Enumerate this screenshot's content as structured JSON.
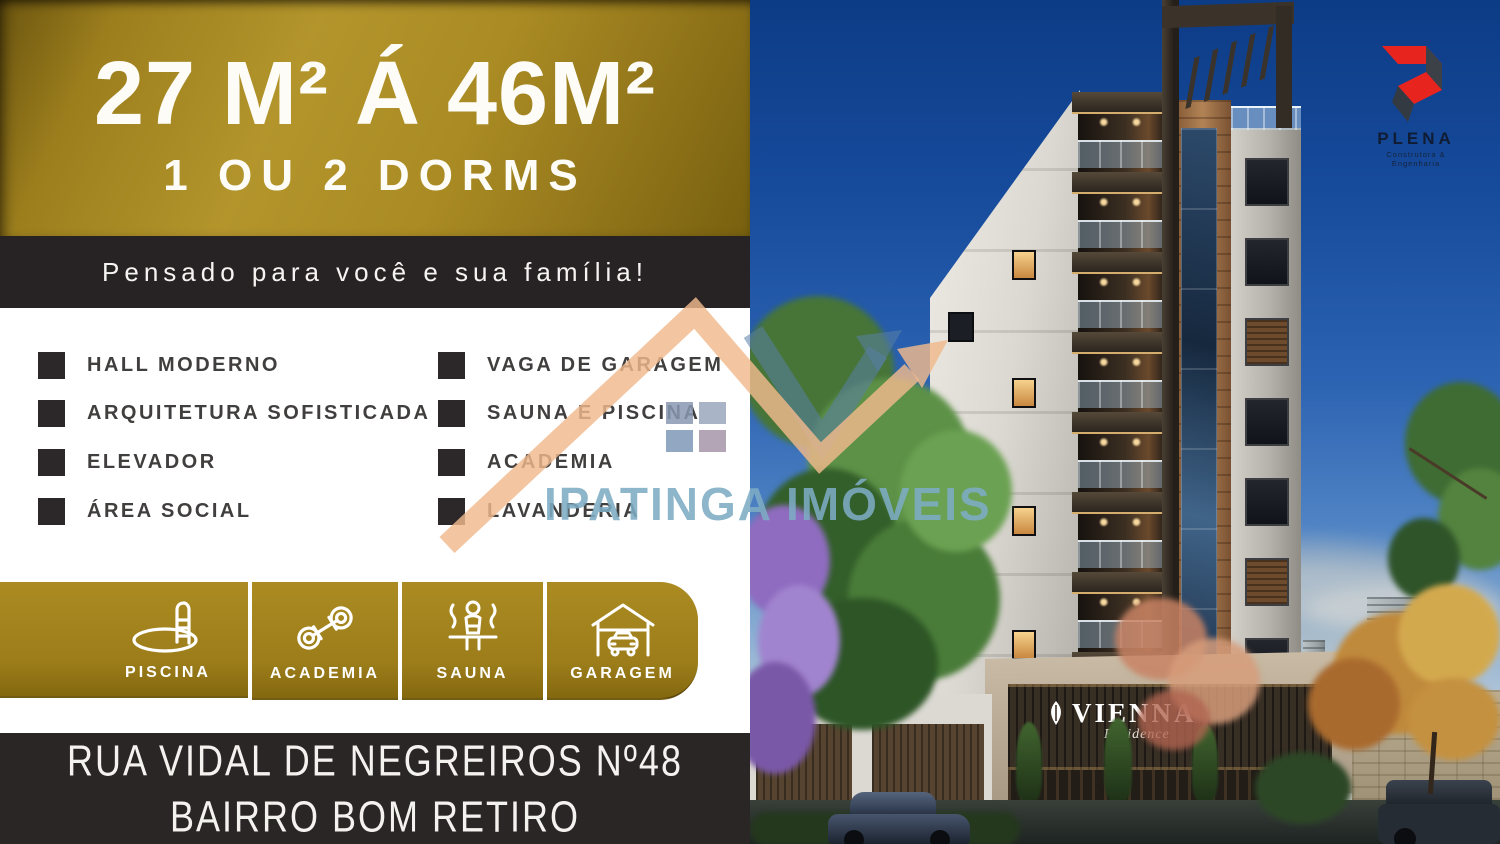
{
  "left": {
    "header": {
      "line1": "27 M² Á 46M²",
      "line2": "1 OU 2 DORMS"
    },
    "tagline": "Pensado para você e sua família!",
    "features": {
      "left": [
        "HALL MODERNO",
        "ARQUITETURA SOFISTICADA",
        "ELEVADOR",
        "ÁREA SOCIAL"
      ],
      "right": [
        "VAGA DE GARAGEM",
        "SAUNA E PISCINA",
        "ACADEMIA",
        "LAVANDERIA"
      ]
    },
    "amenities": [
      {
        "label": "PISCINA",
        "icon": "pool-icon"
      },
      {
        "label": "ACADEMIA",
        "icon": "dumbbell-icon"
      },
      {
        "label": "SAUNA",
        "icon": "sauna-icon"
      },
      {
        "label": "GARAGEM",
        "icon": "garage-icon"
      }
    ],
    "address": {
      "line1": "RUA VIDAL DE NEGREIROS Nº48",
      "line2": "BAIRRO BOM RETIRO"
    }
  },
  "photo": {
    "sign": {
      "name": "VIENNA",
      "subtitle": "Residence"
    },
    "logo": {
      "name": "PLENA",
      "subtitle": "Construtora & Engenharia"
    }
  },
  "watermark": {
    "text": "IPATINGA IMÓVEIS"
  },
  "colors": {
    "gold": "#a8871f",
    "dark_bar": "#272324",
    "accent_red": "#e8241e",
    "logo_dark": "#3c4148",
    "watermark_blue": "#7cacc4",
    "sky_top": "#0d3c86"
  }
}
